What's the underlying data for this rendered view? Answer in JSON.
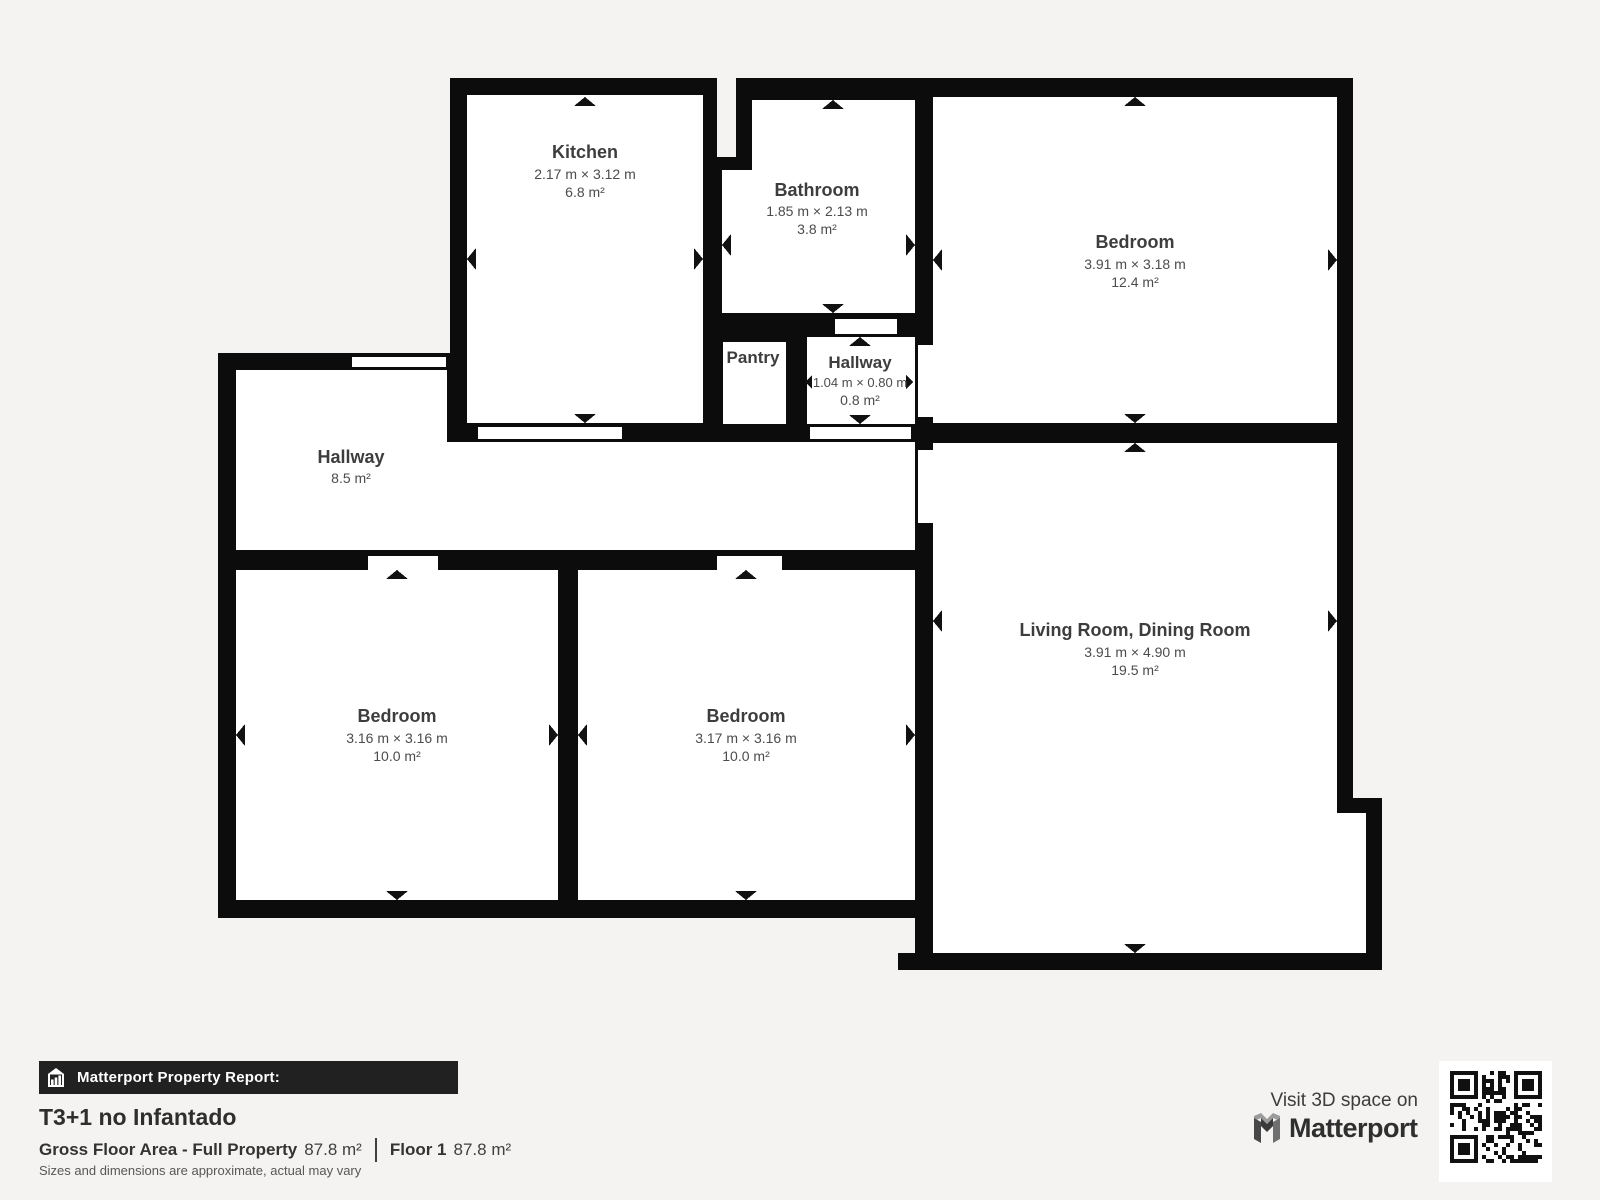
{
  "colors": {
    "background": "#f4f3f1",
    "wall": "#0c0c0c",
    "room_fill": "#ffffff",
    "label_title": "#3d3d3d",
    "label_dims": "#4c4c4c",
    "footer_bar": "#212121"
  },
  "rooms": {
    "kitchen": {
      "name": "Kitchen",
      "dims": "2.17 m × 3.12 m",
      "area": "6.8 m²"
    },
    "bathroom": {
      "name": "Bathroom",
      "dims": "1.85 m × 2.13 m",
      "area": "3.8 m²"
    },
    "bedroom_top_right": {
      "name": "Bedroom",
      "dims": "3.91 m × 3.18 m",
      "area": "12.4 m²"
    },
    "pantry": {
      "name": "Pantry"
    },
    "hallway_small": {
      "name": "Hallway",
      "dims": "1.04 m × 0.80 m",
      "area": "0.8 m²"
    },
    "hallway": {
      "name": "Hallway",
      "area": "8.5 m²"
    },
    "living_room": {
      "name": "Living Room, Dining Room",
      "dims": "3.91 m × 4.90 m",
      "area": "19.5 m²"
    },
    "bedroom_bottom_left": {
      "name": "Bedroom",
      "dims": "3.16 m × 3.16 m",
      "area": "10.0 m²"
    },
    "bedroom_bottom_mid": {
      "name": "Bedroom",
      "dims": "3.17 m × 3.16 m",
      "area": "10.0 m²"
    }
  },
  "footer": {
    "report_label": "Matterport Property Report:",
    "property_title": "T3+1 no Infantado",
    "gross_area_label": "Gross Floor Area - Full Property",
    "gross_area_value": "87.8 m²",
    "floor_label": "Floor 1",
    "floor_area_value": "87.8 m²",
    "disclaimer": "Sizes and dimensions are approximate, actual may vary",
    "visit_text": "Visit 3D space on",
    "brand_name": "Matterport"
  }
}
